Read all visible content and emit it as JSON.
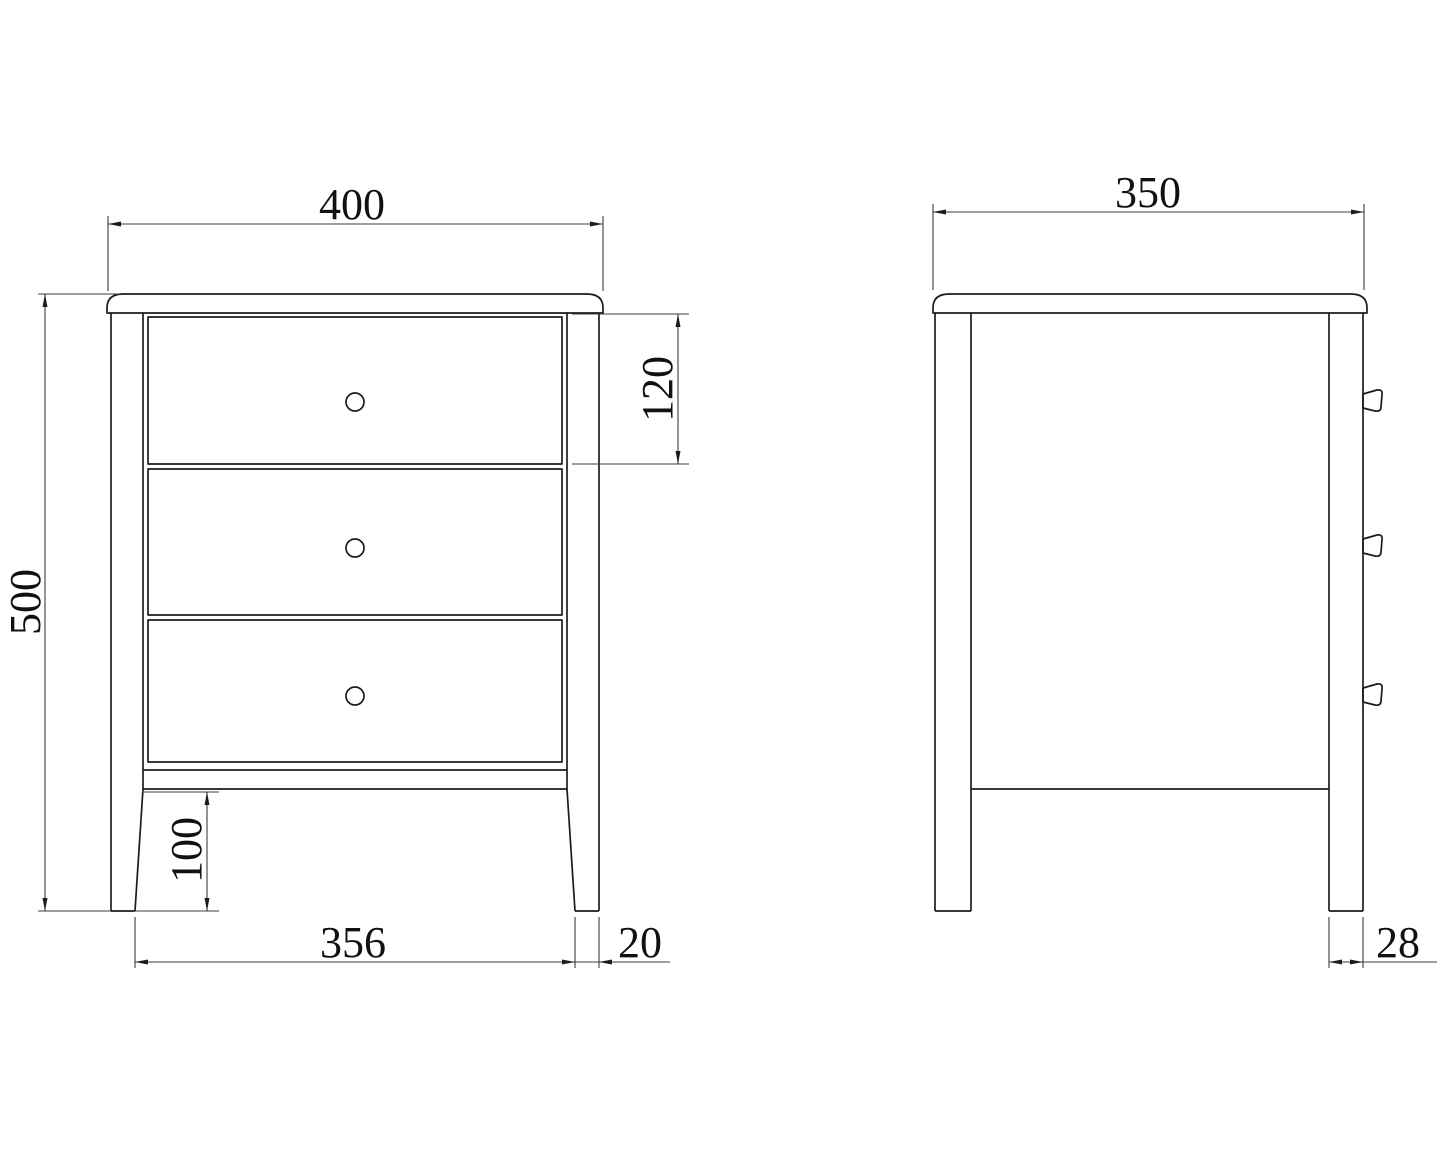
{
  "colors": {
    "background": "#ffffff",
    "object_line": "#1c1c1c",
    "dimension_line": "#3c3c3c",
    "text": "#111111"
  },
  "front_view": {
    "drawer_count": 3,
    "labels": {
      "width": "400",
      "height": "500",
      "drawer_height": "120",
      "leg_height": "100",
      "leg_span": "356",
      "foot_width": "20"
    }
  },
  "side_view": {
    "labels": {
      "depth": "350",
      "leg_width": "28"
    }
  }
}
